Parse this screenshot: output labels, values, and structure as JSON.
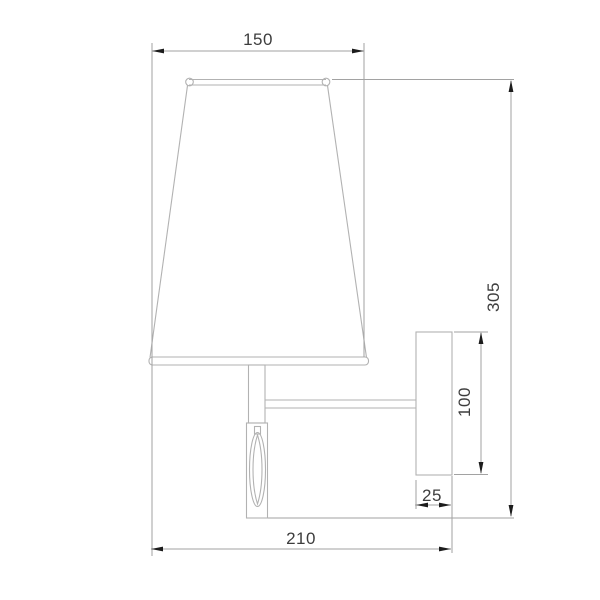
{
  "page": {
    "title": "Wall sconce dimensioned technical drawing",
    "background": "#ffffff"
  },
  "drawing": {
    "type": "dimensioned side elevation",
    "subject": "wall lamp with conical shade, stem with decorative crystal, horizontal arm and wall backplate",
    "units_implied": "mm",
    "colors": {
      "outline": "#b2b2b2",
      "dimension_line": "#a2a2a2",
      "arrowhead": "#1c1c1c",
      "label": "#3d3d3d",
      "background": "#ffffff"
    },
    "dimensions": {
      "shade_width": {
        "value": "150",
        "orientation": "horizontal",
        "position": "top"
      },
      "overall_height": {
        "value": "305",
        "orientation": "vertical",
        "position": "right"
      },
      "backplate_height": {
        "value": "100",
        "orientation": "vertical",
        "position": "right of backplate"
      },
      "backplate_depth": {
        "value": "25",
        "orientation": "horizontal",
        "position": "below backplate"
      },
      "overall_projection": {
        "value": "210",
        "orientation": "horizontal",
        "position": "bottom"
      }
    }
  }
}
